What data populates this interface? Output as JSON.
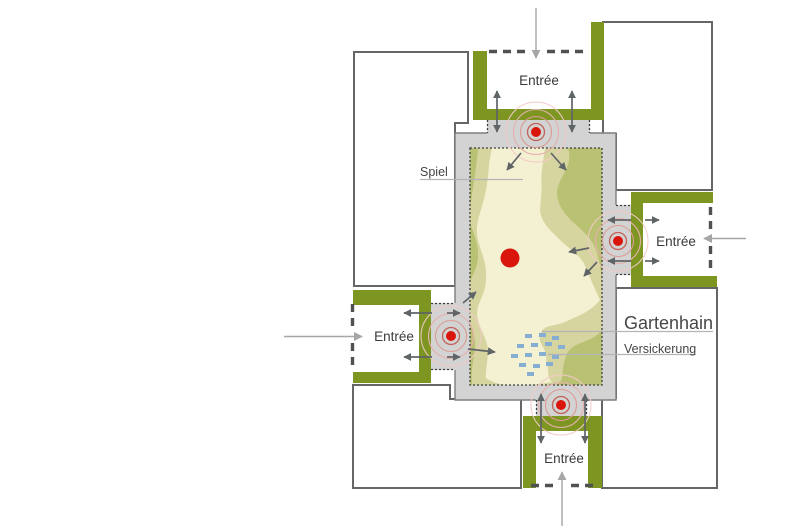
{
  "labels": {
    "entrances": {
      "top": "Entrée",
      "right": "Entrée",
      "left": "Entrée",
      "bottom": "Entrée"
    },
    "play_area": "Spiel",
    "site_name": "Gartenhain",
    "infiltration": "Versickerung"
  },
  "colors": {
    "olive": "#7d9622",
    "paving": "#d3d3d3",
    "paving_outline": "#7e7e7e",
    "building_outline": "#666666",
    "garden_base": "#b9c173",
    "garden_mid": "#d6d5a0",
    "garden_light": "#f4f1d3",
    "gate_red": "#da150b",
    "arrow_dark": "#5f6467",
    "arrow_light": "#a6a6a6",
    "infiltration_blue": "#86aed2"
  }
}
